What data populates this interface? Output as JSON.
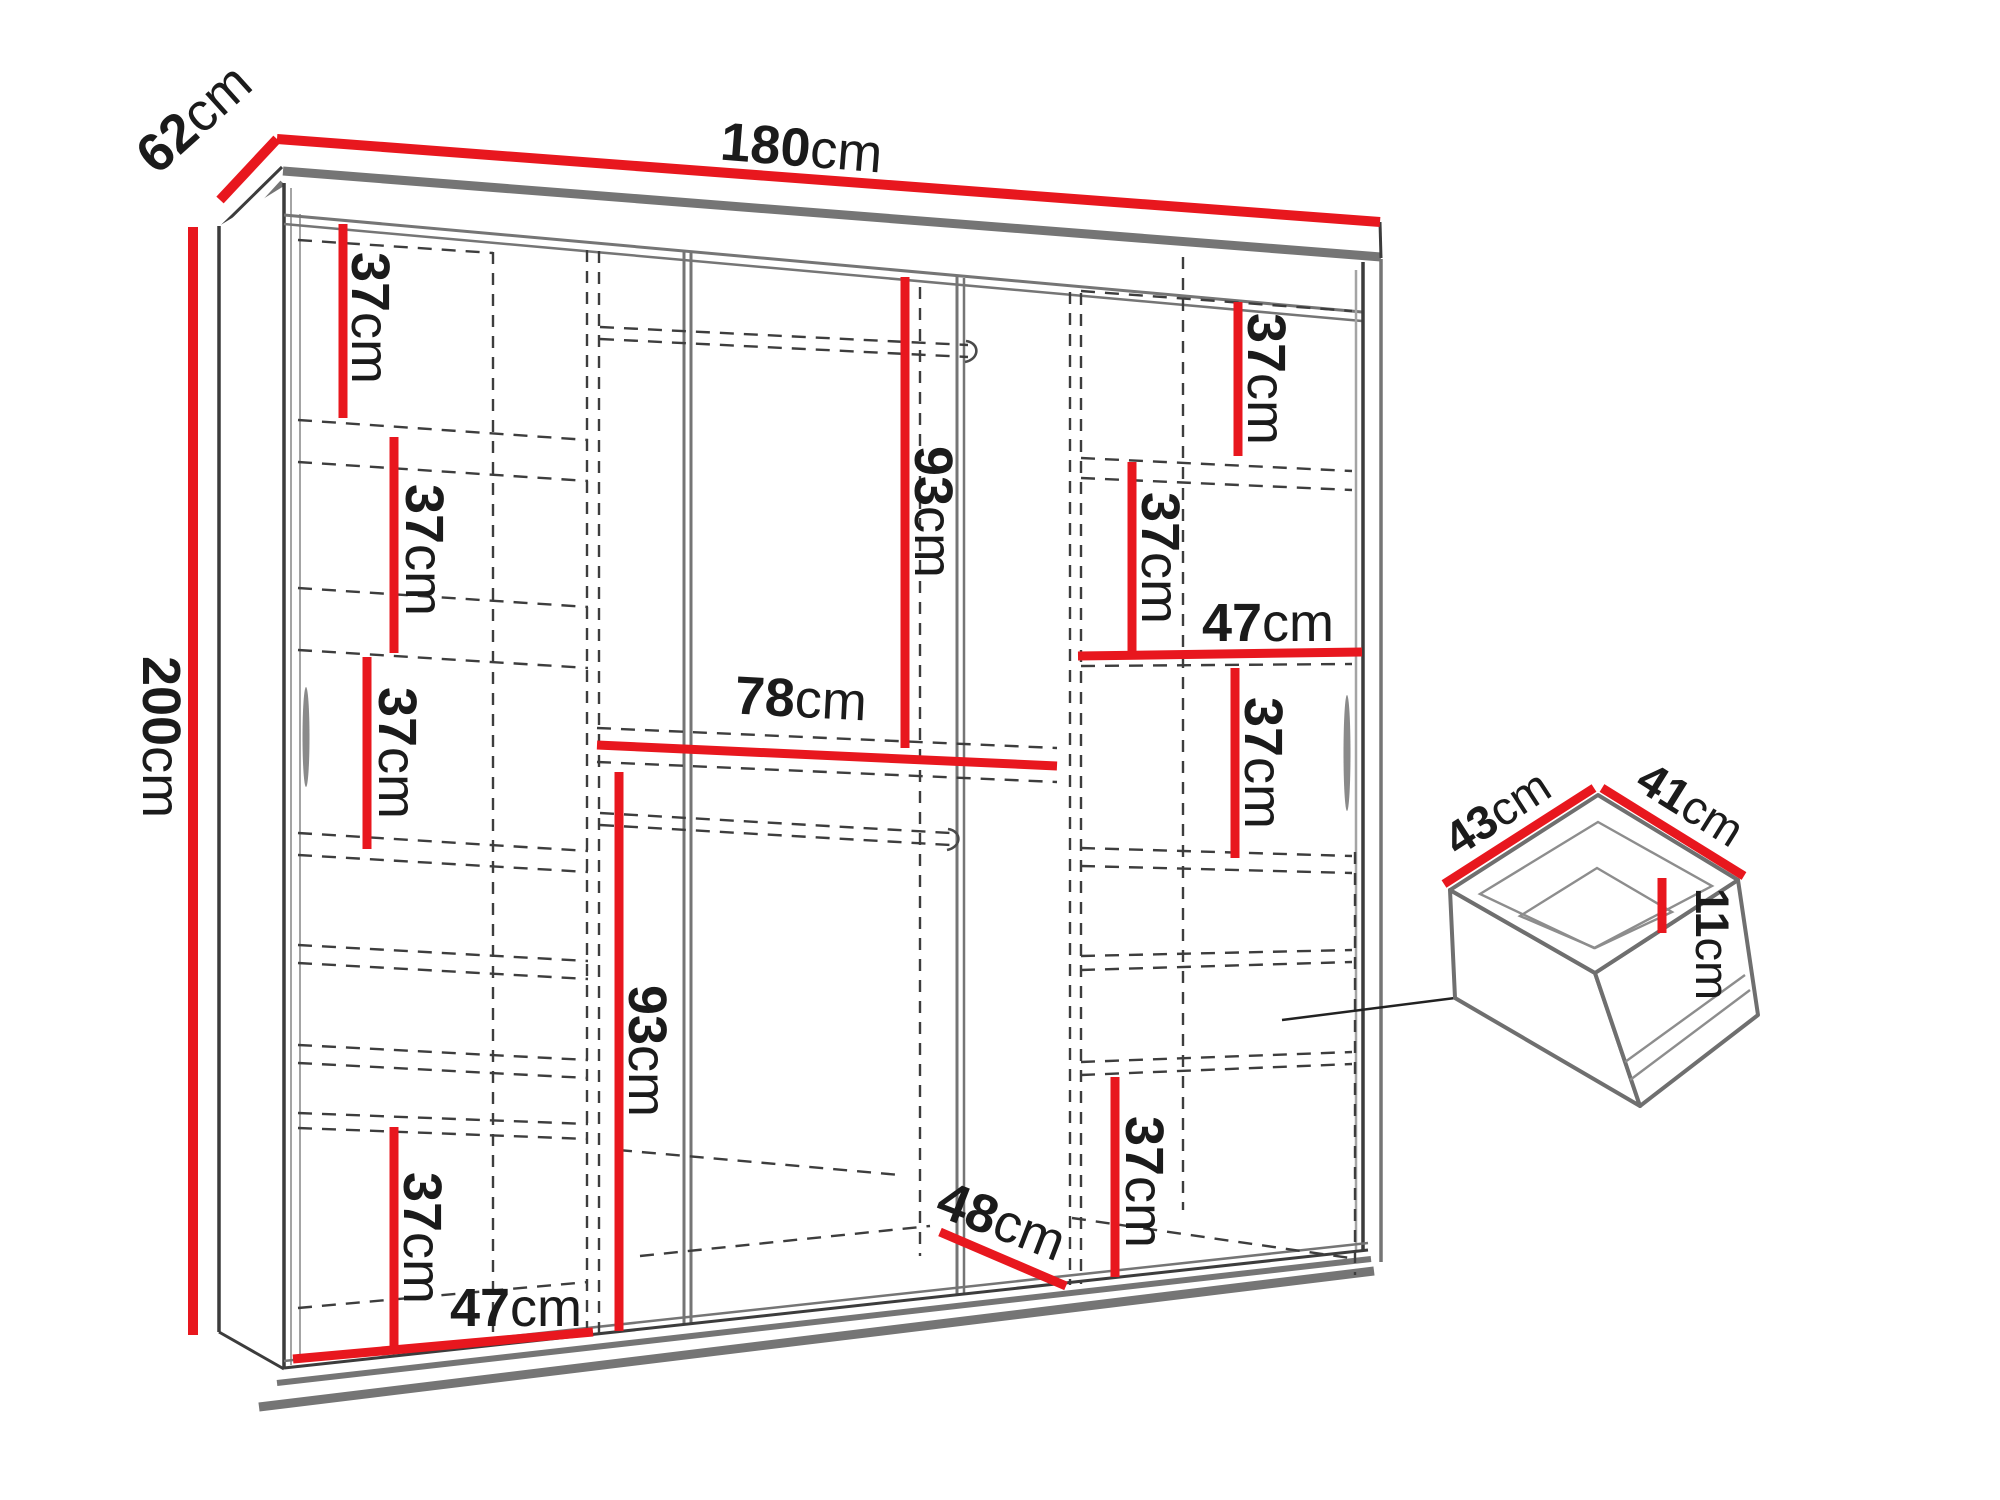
{
  "meta": {
    "subject": "Wardrobe technical dimension diagram (front view) with pull-out drawer detail",
    "colors": {
      "dimension_red": "#e8171e",
      "outline_dark": "#3c3c3c",
      "outline_gray": "#757575",
      "dashed_line": "#3d3d3d",
      "label_text": "#1b1b1b",
      "background": "#ffffff"
    }
  },
  "dims": {
    "width": {
      "v": "180",
      "u": "cm"
    },
    "depth": {
      "v": "62",
      "u": "cm"
    },
    "height": {
      "v": "200",
      "u": "cm"
    },
    "left": {
      "s1": {
        "v": "37",
        "u": "cm"
      },
      "s2": {
        "v": "37",
        "u": "cm"
      },
      "s3": {
        "v": "37",
        "u": "cm"
      },
      "s4": {
        "v": "37",
        "u": "cm"
      },
      "w": {
        "v": "47",
        "u": "cm"
      }
    },
    "mid": {
      "hang_top": {
        "v": "93",
        "u": "cm"
      },
      "shelf": {
        "v": "78",
        "u": "cm"
      },
      "hang_bot": {
        "v": "93",
        "u": "cm"
      },
      "floor": {
        "v": "48",
        "u": "cm"
      }
    },
    "right": {
      "s1": {
        "v": "37",
        "u": "cm"
      },
      "s2": {
        "v": "37",
        "u": "cm"
      },
      "w": {
        "v": "47",
        "u": "cm"
      },
      "s3": {
        "v": "37",
        "u": "cm"
      },
      "s4": {
        "v": "37",
        "u": "cm"
      }
    },
    "drawer": {
      "w": {
        "v": "43",
        "u": "cm"
      },
      "d": {
        "v": "41",
        "u": "cm"
      },
      "h": {
        "v": "11",
        "u": "cm"
      }
    }
  }
}
